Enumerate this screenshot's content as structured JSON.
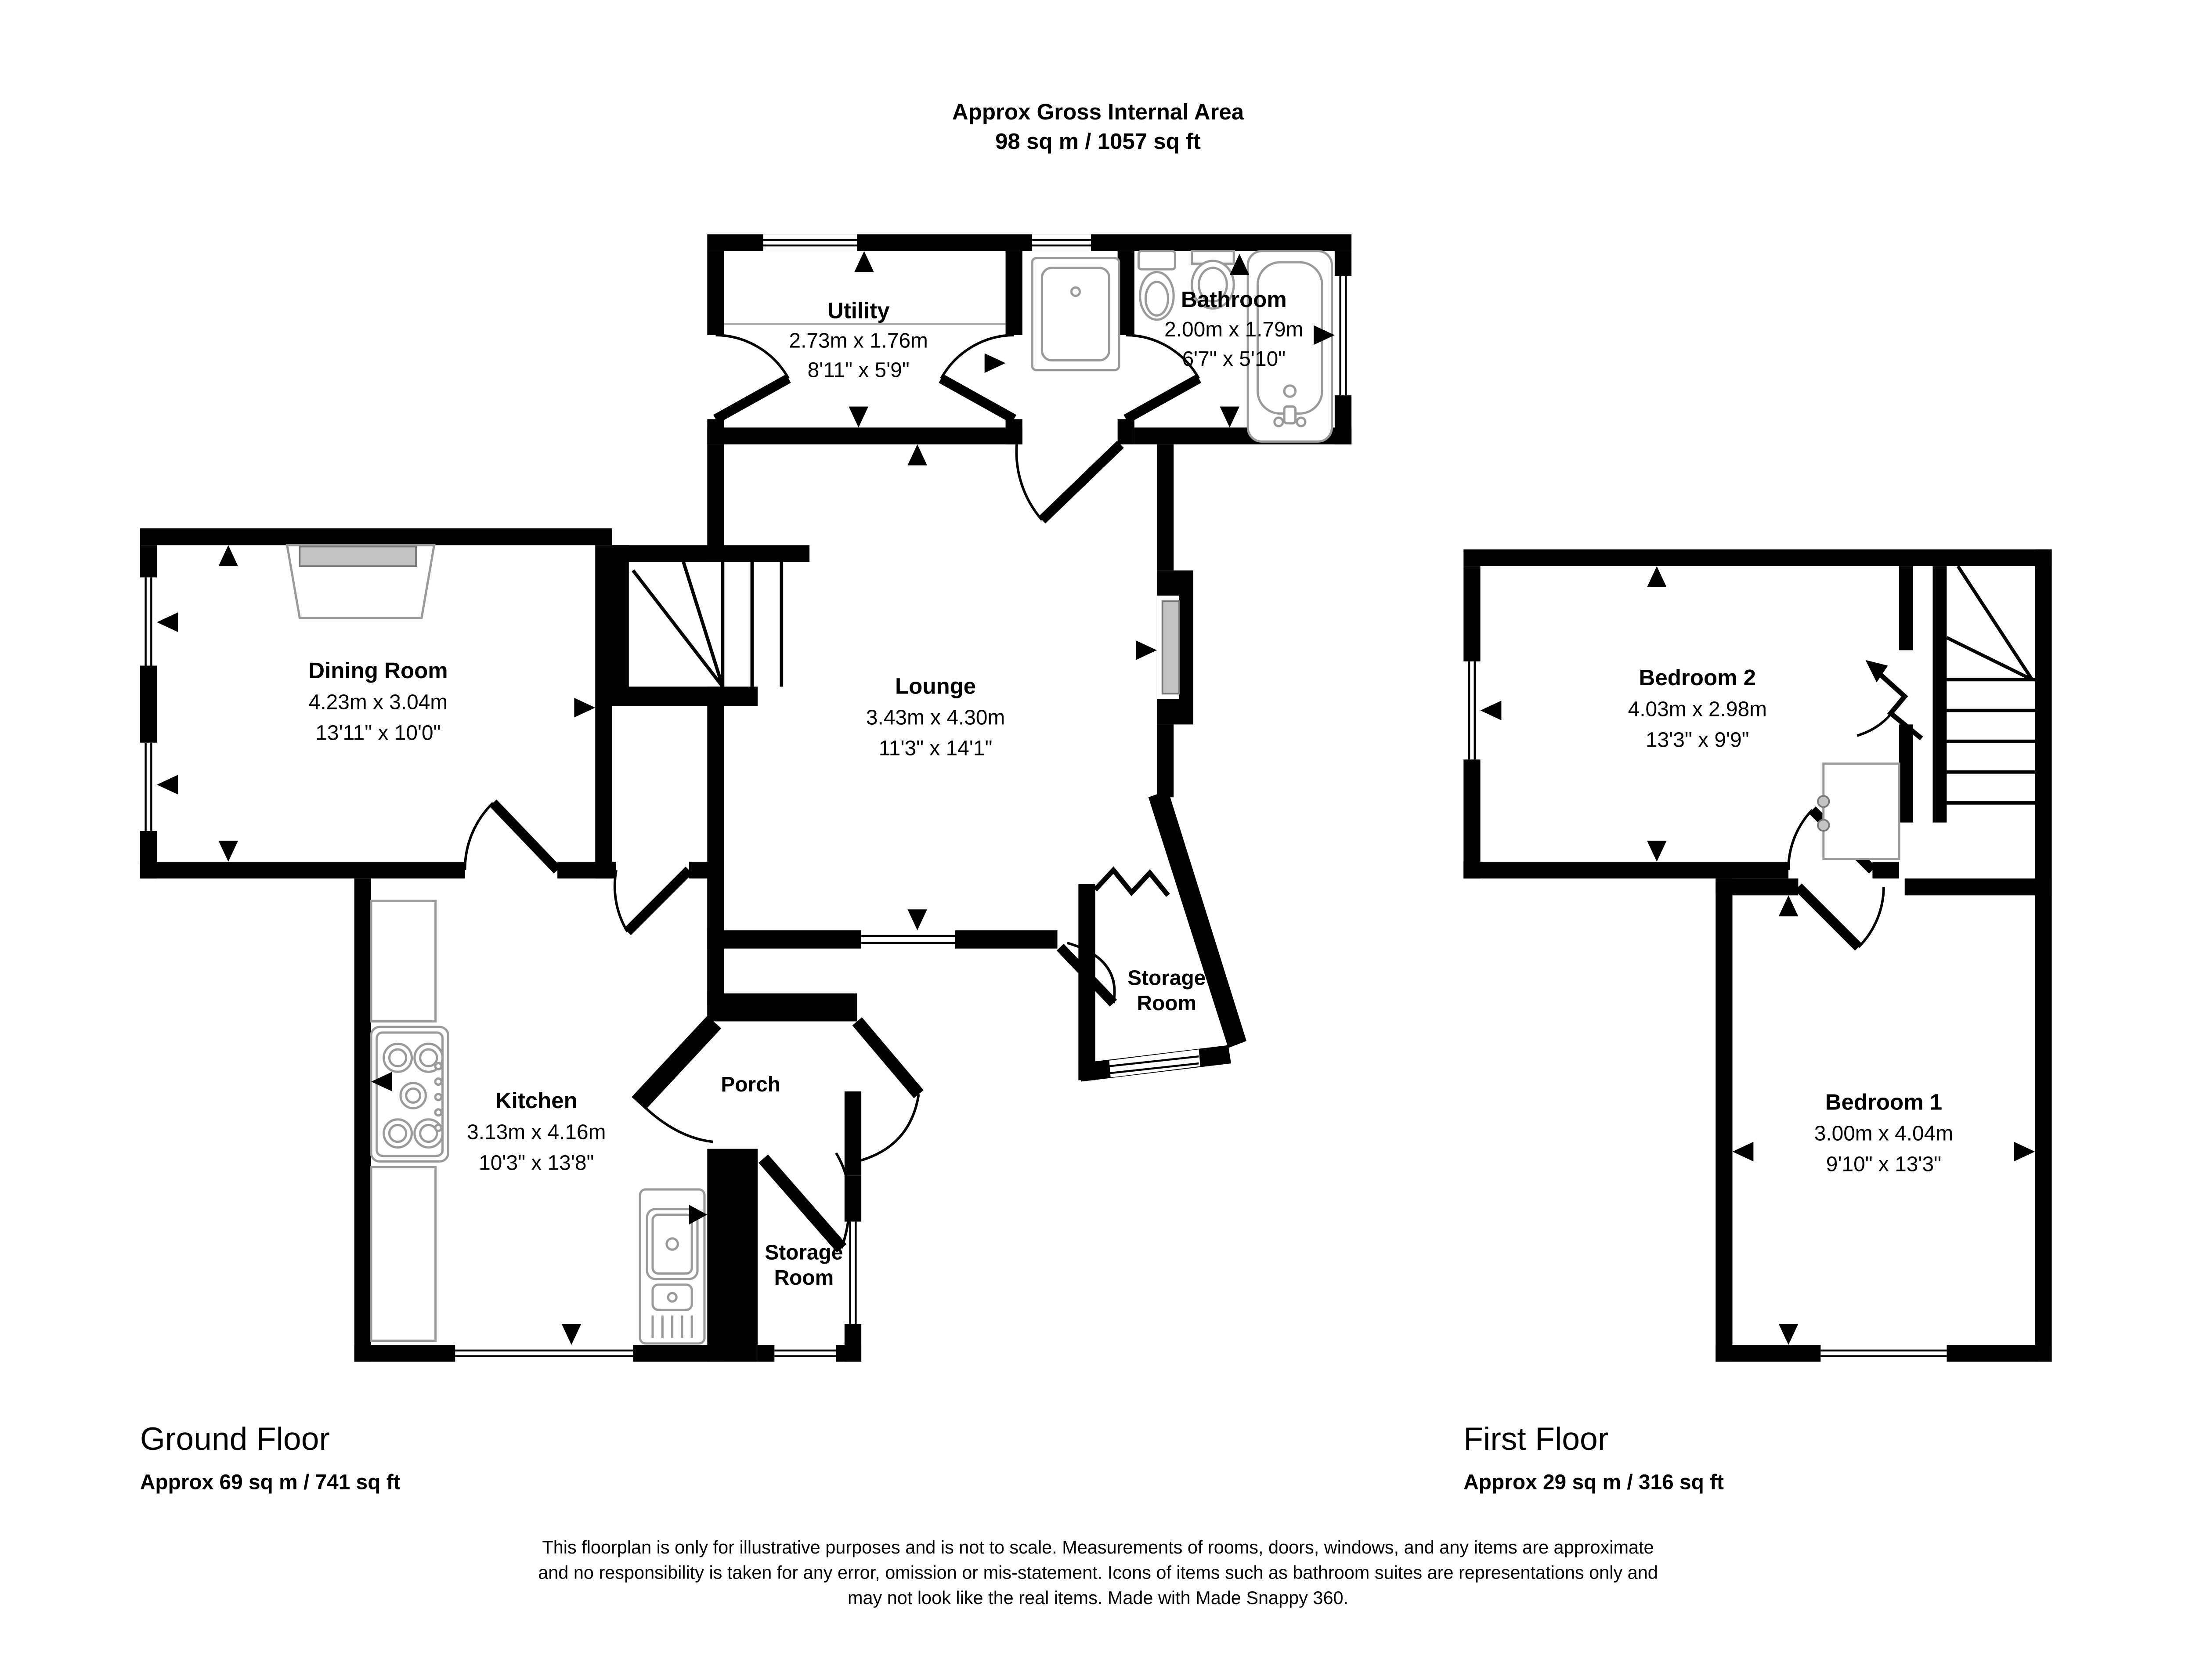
{
  "title": {
    "line1": "Approx Gross Internal Area",
    "line2": "98 sq m / 1057 sq ft"
  },
  "rooms": {
    "utility": {
      "name": "Utility",
      "metric": "2.73m x 1.76m",
      "imperial": "8'11\" x 5'9\""
    },
    "bathroom": {
      "name": "Bathroom",
      "metric": "2.00m x 1.79m",
      "imperial": "6'7\" x 5'10\""
    },
    "dining": {
      "name": "Dining Room",
      "metric": "4.23m x 3.04m",
      "imperial": "13'11\" x 10'0\""
    },
    "lounge": {
      "name": "Lounge",
      "metric": "3.43m x 4.30m",
      "imperial": "11'3\" x 14'1\""
    },
    "kitchen": {
      "name": "Kitchen",
      "metric": "3.13m x 4.16m",
      "imperial": "10'3\" x 13'8\""
    },
    "porch": {
      "name": "Porch"
    },
    "storage_right": {
      "line1": "Storage",
      "line2": "Room"
    },
    "storage_bottom": {
      "line1": "Storage",
      "line2": "Room"
    },
    "bedroom2": {
      "name": "Bedroom 2",
      "metric": "4.03m x 2.98m",
      "imperial": "13'3\" x 9'9\""
    },
    "bedroom1": {
      "name": "Bedroom 1",
      "metric": "3.00m x 4.04m",
      "imperial": "9'10\" x 13'3\""
    }
  },
  "floors": {
    "ground": {
      "label": "Ground Floor",
      "area": "Approx 69 sq m / 741 sq ft"
    },
    "first": {
      "label": "First Floor",
      "area": "Approx 29 sq m / 316 sq ft"
    }
  },
  "disclaimer": {
    "line1": "This floorplan is only for illustrative purposes and is not to scale. Measurements of rooms, doors, windows, and any items are approximate",
    "line2": "and no responsibility is taken for any error, omission or mis-statement. Icons of items such as bathroom suites are representations only and",
    "line3": "may not look like the real items. Made with Made Snappy 360."
  },
  "colors": {
    "wall": "#000000",
    "background": "#ffffff",
    "fixture_outline": "#9a9a9a",
    "fixture_fill": "#c4c4c4"
  }
}
